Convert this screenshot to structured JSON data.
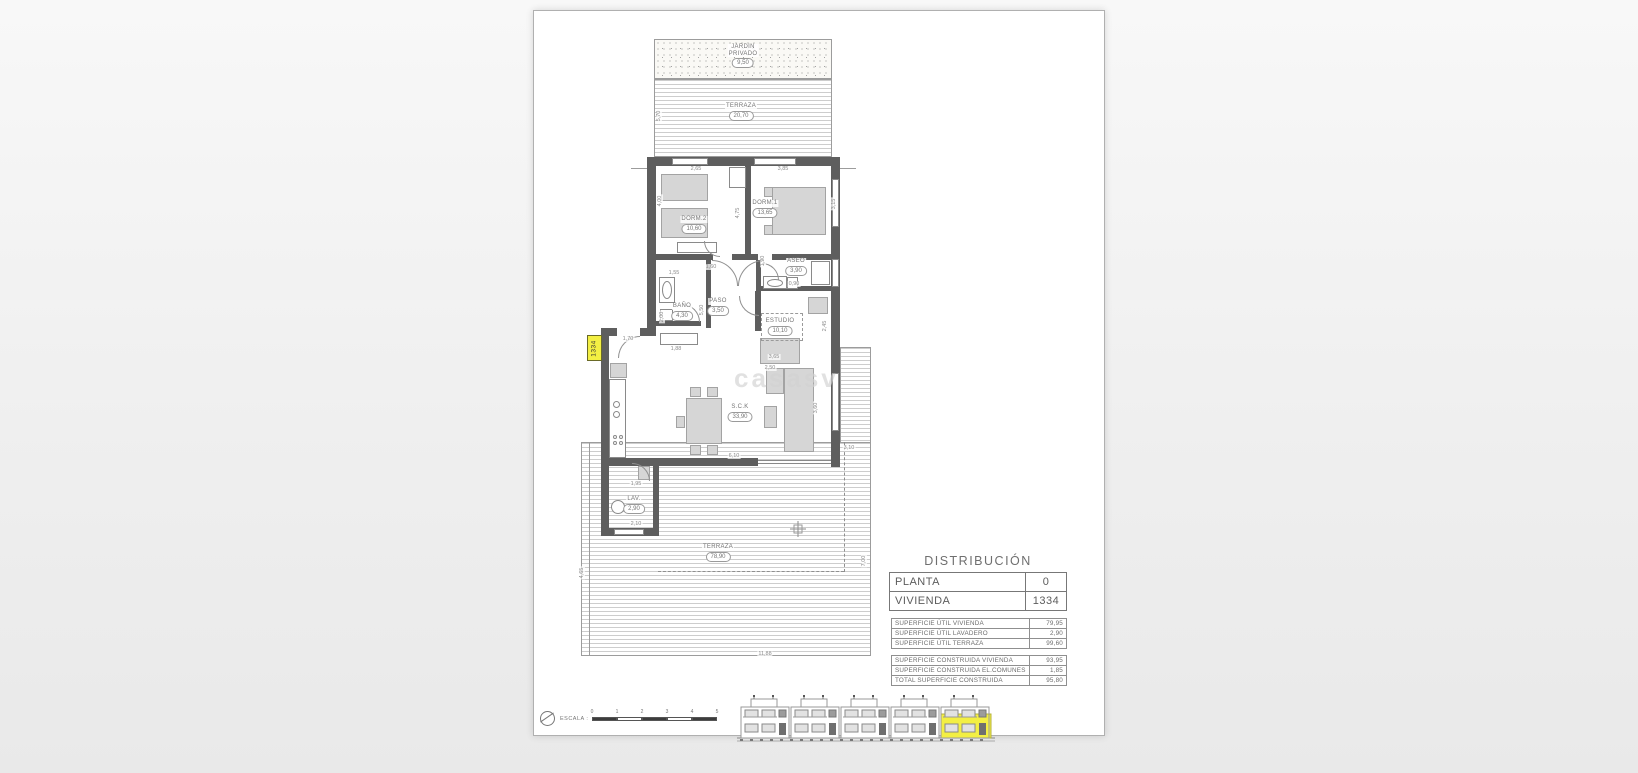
{
  "watermark": "casasv",
  "unit_badge": "1334",
  "distribution": {
    "title": "DISTRIBUCIÓN",
    "header_rows": [
      {
        "label": "PLANTA",
        "value": "0"
      },
      {
        "label": "VIVIENDA",
        "value": "1334"
      }
    ],
    "area_tables": [
      {
        "rows": [
          [
            "SUPERFICIE ÚTIL VIVIENDA",
            "79,95"
          ],
          [
            "SUPERFICIE ÚTIL LAVADERO",
            "2,90"
          ],
          [
            "SUPERFICIE ÚTIL TERRAZA",
            "99,60"
          ]
        ]
      },
      {
        "rows": [
          [
            "SUPERFICIE CONSTRUIDA VIVIENDA",
            "93,95"
          ],
          [
            "SUPERFICIE CONSTRUIDA EL.COMUNES",
            "1,85"
          ],
          [
            "TOTAL SUPERFICIE CONSTRUIDA",
            "95,80"
          ]
        ]
      }
    ]
  },
  "rooms": [
    {
      "id": "jardin-privado",
      "name": "JARDIN\nPRIVADO",
      "area": "9,50",
      "x": 209,
      "y": 33
    },
    {
      "id": "terraza-superior",
      "name": "TERRAZA",
      "area": "20,70",
      "x": 207,
      "y": 92
    },
    {
      "id": "dorm-2",
      "name": "DORM.2",
      "area": "10,60",
      "x": 160,
      "y": 205
    },
    {
      "id": "dorm-1",
      "name": "DORM.1",
      "area": "13,65",
      "x": 231,
      "y": 189
    },
    {
      "id": "aseo",
      "name": "ASEO",
      "area": "3,90",
      "x": 262,
      "y": 247
    },
    {
      "id": "bano",
      "name": "BAÑO",
      "area": "4,30",
      "x": 148,
      "y": 292
    },
    {
      "id": "paso",
      "name": "PASO",
      "area": "3,50",
      "x": 184,
      "y": 287
    },
    {
      "id": "estudio",
      "name": "ESTUDIO",
      "area": "10,10",
      "x": 246,
      "y": 307
    },
    {
      "id": "salon-cocina",
      "name": "S.C.K",
      "area": "33,90",
      "x": 206,
      "y": 393
    },
    {
      "id": "lavadero",
      "name": "LAV.",
      "area": "2,90",
      "x": 100,
      "y": 485
    },
    {
      "id": "terraza-principal",
      "name": "TERRAZA",
      "area": "78,90",
      "x": 184,
      "y": 533
    }
  ],
  "dimensions": [
    {
      "t": "2,65",
      "x": 162,
      "y": 158
    },
    {
      "t": "3,85",
      "x": 249,
      "y": 158
    },
    {
      "t": "4,00",
      "x": 126,
      "y": 190,
      "v": true
    },
    {
      "t": "4,75",
      "x": 204,
      "y": 202,
      "v": true
    },
    {
      "t": "3,15",
      "x": 300,
      "y": 193,
      "v": true
    },
    {
      "t": "5,70",
      "x": 125,
      "y": 105,
      "v": true
    },
    {
      "t": "1,55",
      "x": 140,
      "y": 262
    },
    {
      "t": "1,60",
      "x": 177,
      "y": 256
    },
    {
      "t": "1,90",
      "x": 229,
      "y": 250,
      "v": true
    },
    {
      "t": "0,90",
      "x": 260,
      "y": 273
    },
    {
      "t": "2,45",
      "x": 291,
      "y": 315,
      "v": true
    },
    {
      "t": "3,65",
      "x": 240,
      "y": 346
    },
    {
      "t": "2,50",
      "x": 236,
      "y": 357
    },
    {
      "t": "5,50",
      "x": 168,
      "y": 299,
      "v": true
    },
    {
      "t": "2,00",
      "x": 128,
      "y": 306,
      "v": true
    },
    {
      "t": "1,88",
      "x": 142,
      "y": 338
    },
    {
      "t": "1,70",
      "x": 94,
      "y": 328
    },
    {
      "t": "3,60",
      "x": 282,
      "y": 397,
      "v": true
    },
    {
      "t": "6,10",
      "x": 200,
      "y": 445
    },
    {
      "t": "1,95",
      "x": 102,
      "y": 473
    },
    {
      "t": "2,10",
      "x": 102,
      "y": 513
    },
    {
      "t": "3,10",
      "x": 315,
      "y": 437
    },
    {
      "t": "11,88",
      "x": 231,
      "y": 643
    },
    {
      "t": "7,00",
      "x": 330,
      "y": 550,
      "v": true
    },
    {
      "t": "4,65",
      "x": 48,
      "y": 562,
      "v": true
    }
  ],
  "scale_bar": {
    "label": "ESCALA :",
    "ticks": [
      "0",
      "1",
      "2",
      "3",
      "4",
      "5"
    ]
  },
  "colors": {
    "wall": "#5e5e5e",
    "highlight_yellow": "#f3ef43",
    "furniture": "#d6d6d6",
    "deck_line": "#cdcdcd",
    "table_border": "#8f8f8f"
  }
}
